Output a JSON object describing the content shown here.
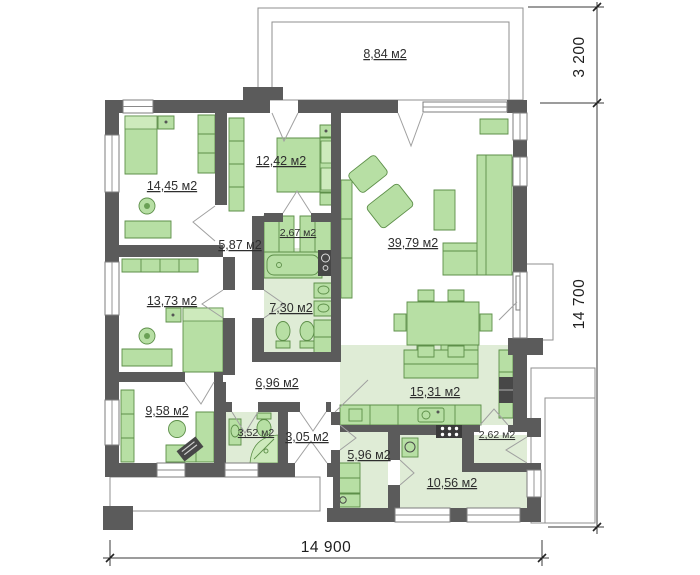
{
  "floor_plan": {
    "rooms": {
      "terrace": "8,84 м2",
      "bedroom_top_left": "14,45 м2",
      "bedroom_top_mid": "12,42 м2",
      "wardrobe": "2,67 м2",
      "hall_upper": "5,87 м2",
      "living": "39,79 м2",
      "bathroom": "7,30 м2",
      "bedroom_left": "13,73 м2",
      "office": "9,58 м2",
      "hall_lower": "6,96 м2",
      "wc": "3,52 м2",
      "entry": "3,05 м2",
      "mudroom": "5,96 м2",
      "kitchen": "15,31 м2",
      "pantry": "2,62 м2",
      "utility": "10,56 м2"
    },
    "dimensions": {
      "overall_width": "14 900",
      "overall_height": "14 700",
      "terrace_depth": "3 200"
    },
    "colors": {
      "wall": "#5b5b5b",
      "furniture": "#b7dfa4",
      "floor_tint": "#dfecd6"
    }
  }
}
